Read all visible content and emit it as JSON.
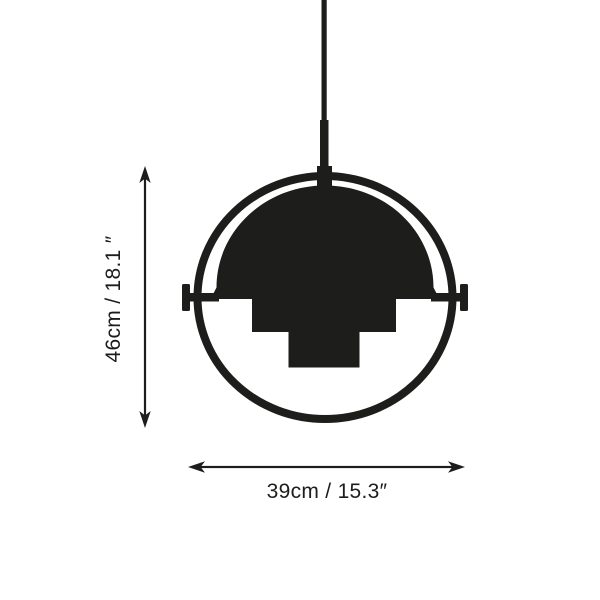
{
  "diagram": {
    "subject": "pendant-lamp-dimension-drawing",
    "colors": {
      "ink": "#1d1d1b",
      "background": "#ffffff"
    },
    "dimensions": {
      "height_label": "46cm / 18.1 ″",
      "width_label": "39cm / 15.3″"
    }
  }
}
